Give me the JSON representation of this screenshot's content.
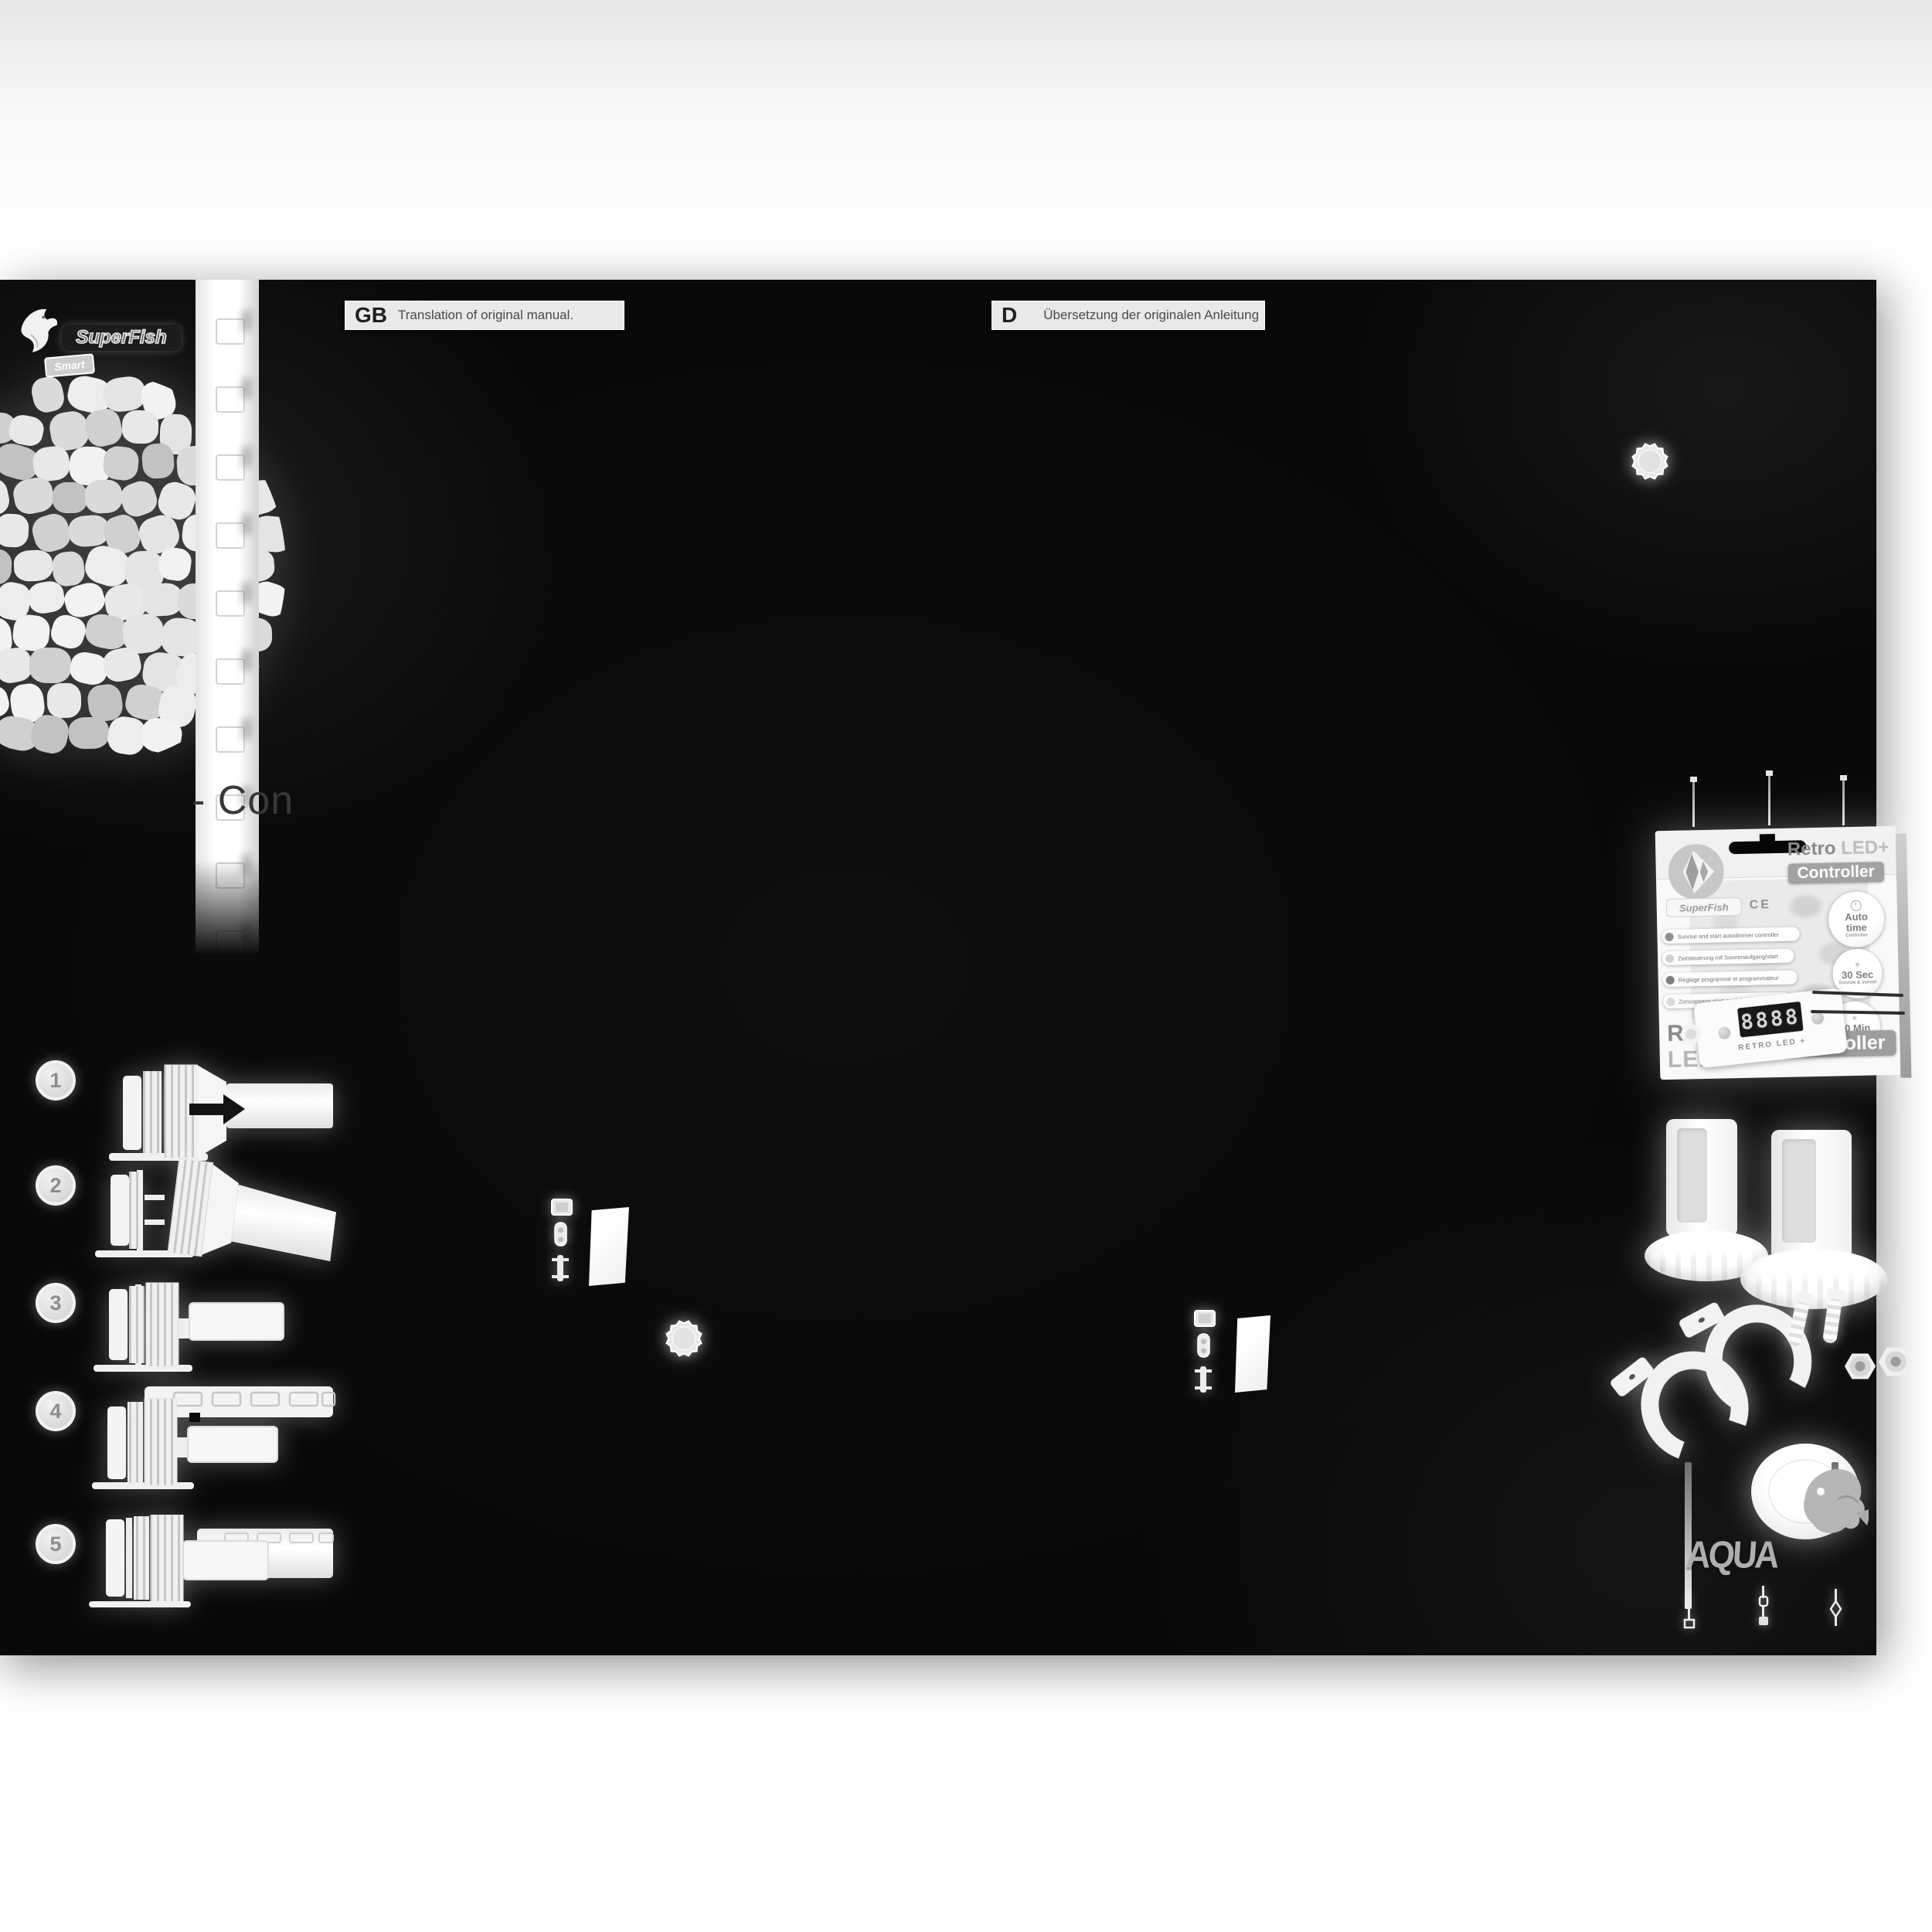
{
  "brand": {
    "name": "SuperFish",
    "tag": "Smart"
  },
  "headers": {
    "gb_code": "GB",
    "gb_text": "Translation of original manual.",
    "d_code": "D",
    "d_text": "Übersetzung der originalen Anleitung"
  },
  "partial_title": "- Con",
  "steps": [
    {
      "n": "1"
    },
    {
      "n": "2"
    },
    {
      "n": "3"
    },
    {
      "n": "4"
    },
    {
      "n": "5"
    }
  ],
  "box": {
    "title_top_1": "Retro",
    "title_top_2": "LED+",
    "title_top_badge": "Controller",
    "brand": "SuperFish",
    "ce": "CE",
    "features": [
      "Sunrise and start autodimmer controller",
      "Zeitsteuerung mit Sonnenaufgang/start",
      "Réglage programmé et programmateur",
      "Zonsopgang start en tijdklok controller"
    ],
    "badge1": {
      "l1": "Auto",
      "l2": "time",
      "l3": "Controller"
    },
    "badge2": {
      "l1": "30 Sec",
      "l3": "Sunrise & sunset"
    },
    "badge3": {
      "l1": "10 Min",
      "l3": "Sunrise & sunset"
    },
    "display": "8888",
    "device_label": "RETRO LED +",
    "title_bottom_1": "Retro",
    "title_bottom_2": "LED+",
    "title_bottom_badge": "Controller"
  },
  "aqua": "AQUA",
  "colors": {
    "page_black": "#090909",
    "bar_gray": "#e9e9e9",
    "badge_gray": "#9e9e9e"
  }
}
